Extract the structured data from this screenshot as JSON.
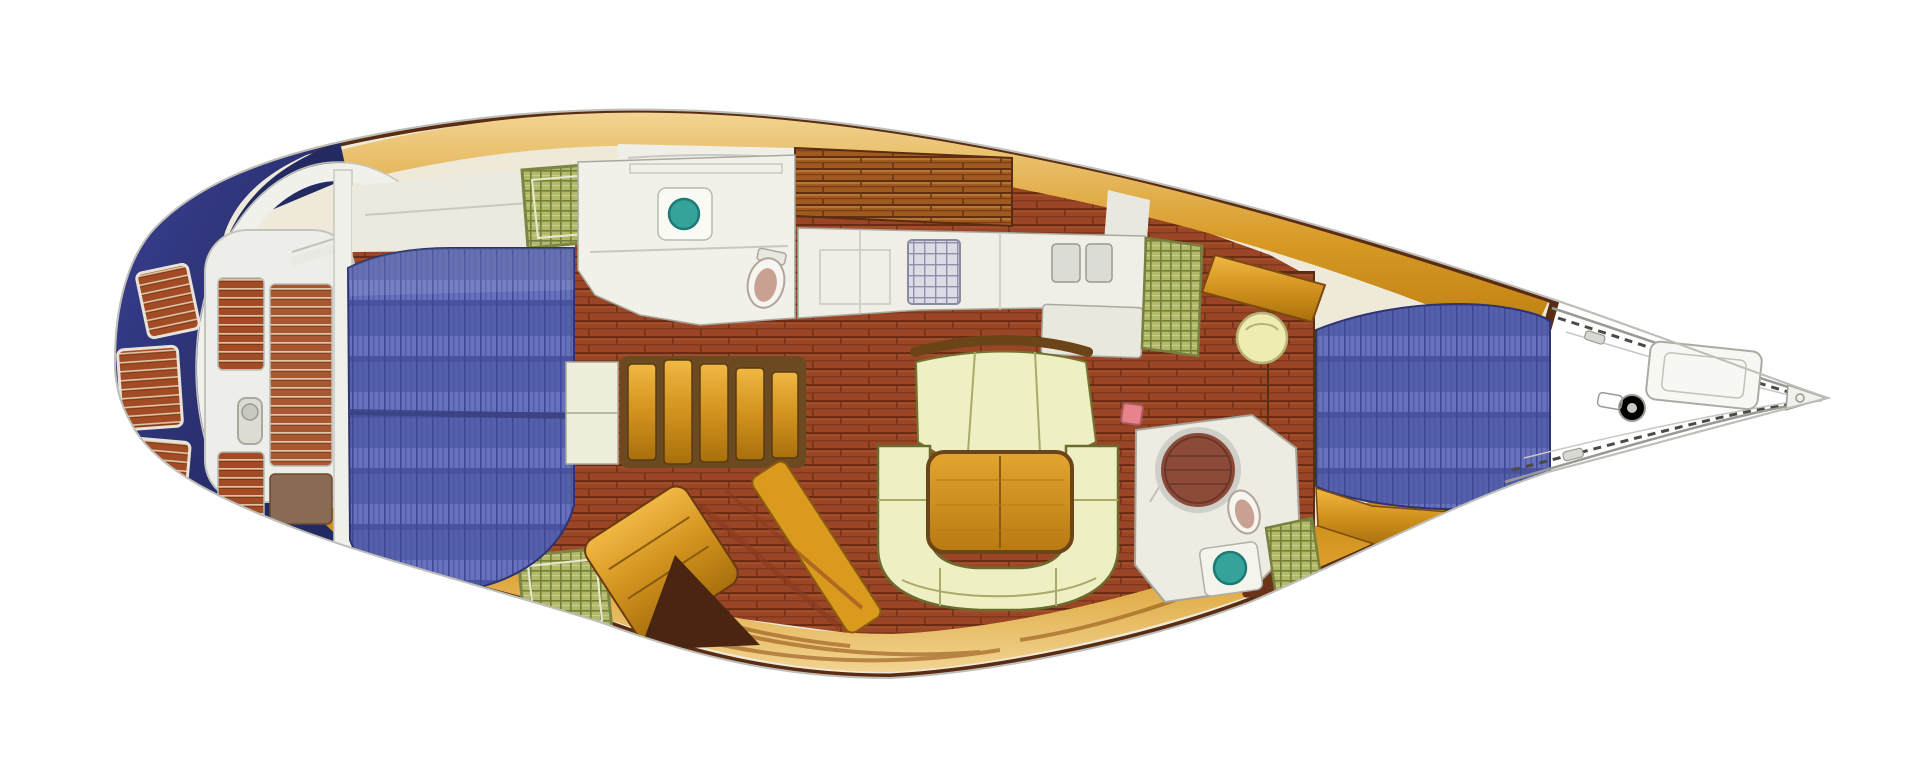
{
  "figure": {
    "title": "Sailboat interior floor plan, top view, bow to the right",
    "type": "yacht-deck-plan"
  },
  "regions": {
    "figure": "Sailboat interior floor plan, top view",
    "stern": "Stern hull and transom",
    "swim_platform": "Swim platform teak steps",
    "cockpit": "Cockpit with teak seats",
    "pedestal": "Steering pedestal",
    "aft_cabin_berth": "Aft cabin double berth",
    "aft_bench": "Aft cabin bench and passage",
    "aft_head": "Aft head compartment",
    "toilet": "Toilet",
    "basin": "Washbasin",
    "companionway": "Companionway steps",
    "steps_cabinet": "Cabinet beside companionway",
    "galley": "Galley counters",
    "stove": "Stove top",
    "galley_sink": "Galley twin sinks",
    "chart_table": "Chart table",
    "salon": "Salon",
    "settee": "U-shaped settee",
    "salon_bench": "Salon forward bench",
    "table": "Salon table",
    "mast": "Mast step",
    "door": "Louvered door",
    "stool": "Round stool",
    "forward_head": "Forward head compartment",
    "shower": "Circular shower with teak grate",
    "forward_cabin": "Forward cabin V-berth",
    "dresser": "Forward cabin dresser",
    "locker": "Locker",
    "deck_hatch": "Deck hatch",
    "side_deck_top": "Port side deck",
    "side_deck_bottom": "Starboard side deck",
    "cabin_top": "Coachroof teak panel",
    "foredeck": "Foredeck line drawing",
    "anchor_locker": "Anchor locker",
    "windlass": "Anchor windlass",
    "pulpit": "Bow pulpit and lifelines",
    "bow_fitting": "Bow stem fitting"
  },
  "palette": {
    "hull_navy": "#232a62",
    "hull_navy_light": "#3a4090",
    "deck_orange": "#d89a25",
    "deck_pale": "#f2d492",
    "deck_deep": "#b97a0c",
    "wood_floor": "#9a4526",
    "wood_floor_dark": "#6b2c13",
    "teak_band": "#a05a20",
    "hull_trim": "#5a2c12",
    "mattress_blue": "#5560aa",
    "mattress_line": "#3f4896",
    "settee_cream": "#efefc4",
    "settee_outline": "#6b6b2e",
    "table_amber": "#d2921e",
    "hatch_green": "#b2b968",
    "hatch_green_line": "#747f38",
    "basin_teal": "#35a39a",
    "furniture_white": "#f0efe8",
    "line_art_grey": "#9a9a94",
    "shower_teak": "#8c4a38",
    "toilet_inner": "#c9a193",
    "mast_pink": "#e9838b"
  }
}
